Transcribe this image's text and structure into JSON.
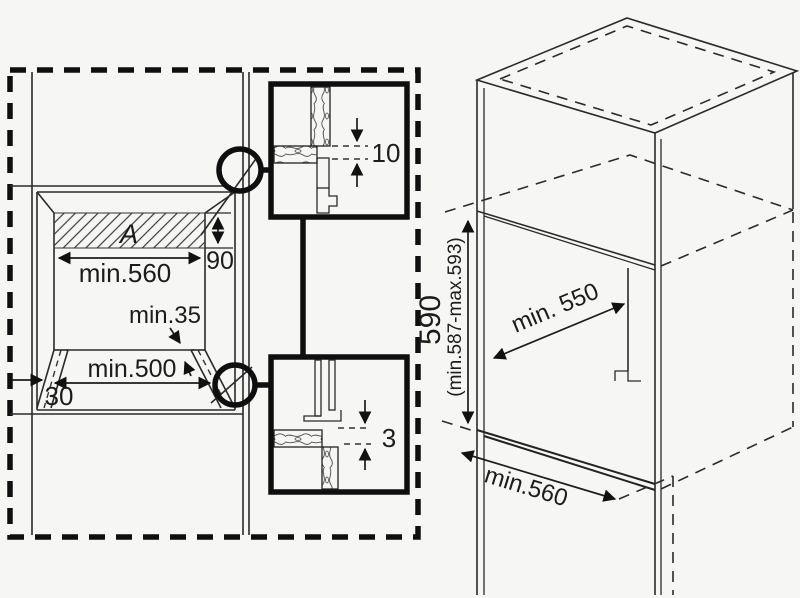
{
  "front_view": {
    "recess_label": "A",
    "recess_height": "90",
    "niche_width": "min.560",
    "corner_clearance": "min.35",
    "base_opening_width": "min.500",
    "corner_offset": "30"
  },
  "detail_top": {
    "gap": "10"
  },
  "detail_bottom": {
    "gap": "3"
  },
  "iso_view": {
    "niche_height": "590",
    "niche_height_range": "(min.587-max.593)",
    "niche_depth": "min. 550",
    "cabinet_width": "min.560"
  },
  "colors": {
    "line": "#2a2a2a",
    "heavy_line": "#0f0f0f",
    "background": "#f6f6f4"
  }
}
